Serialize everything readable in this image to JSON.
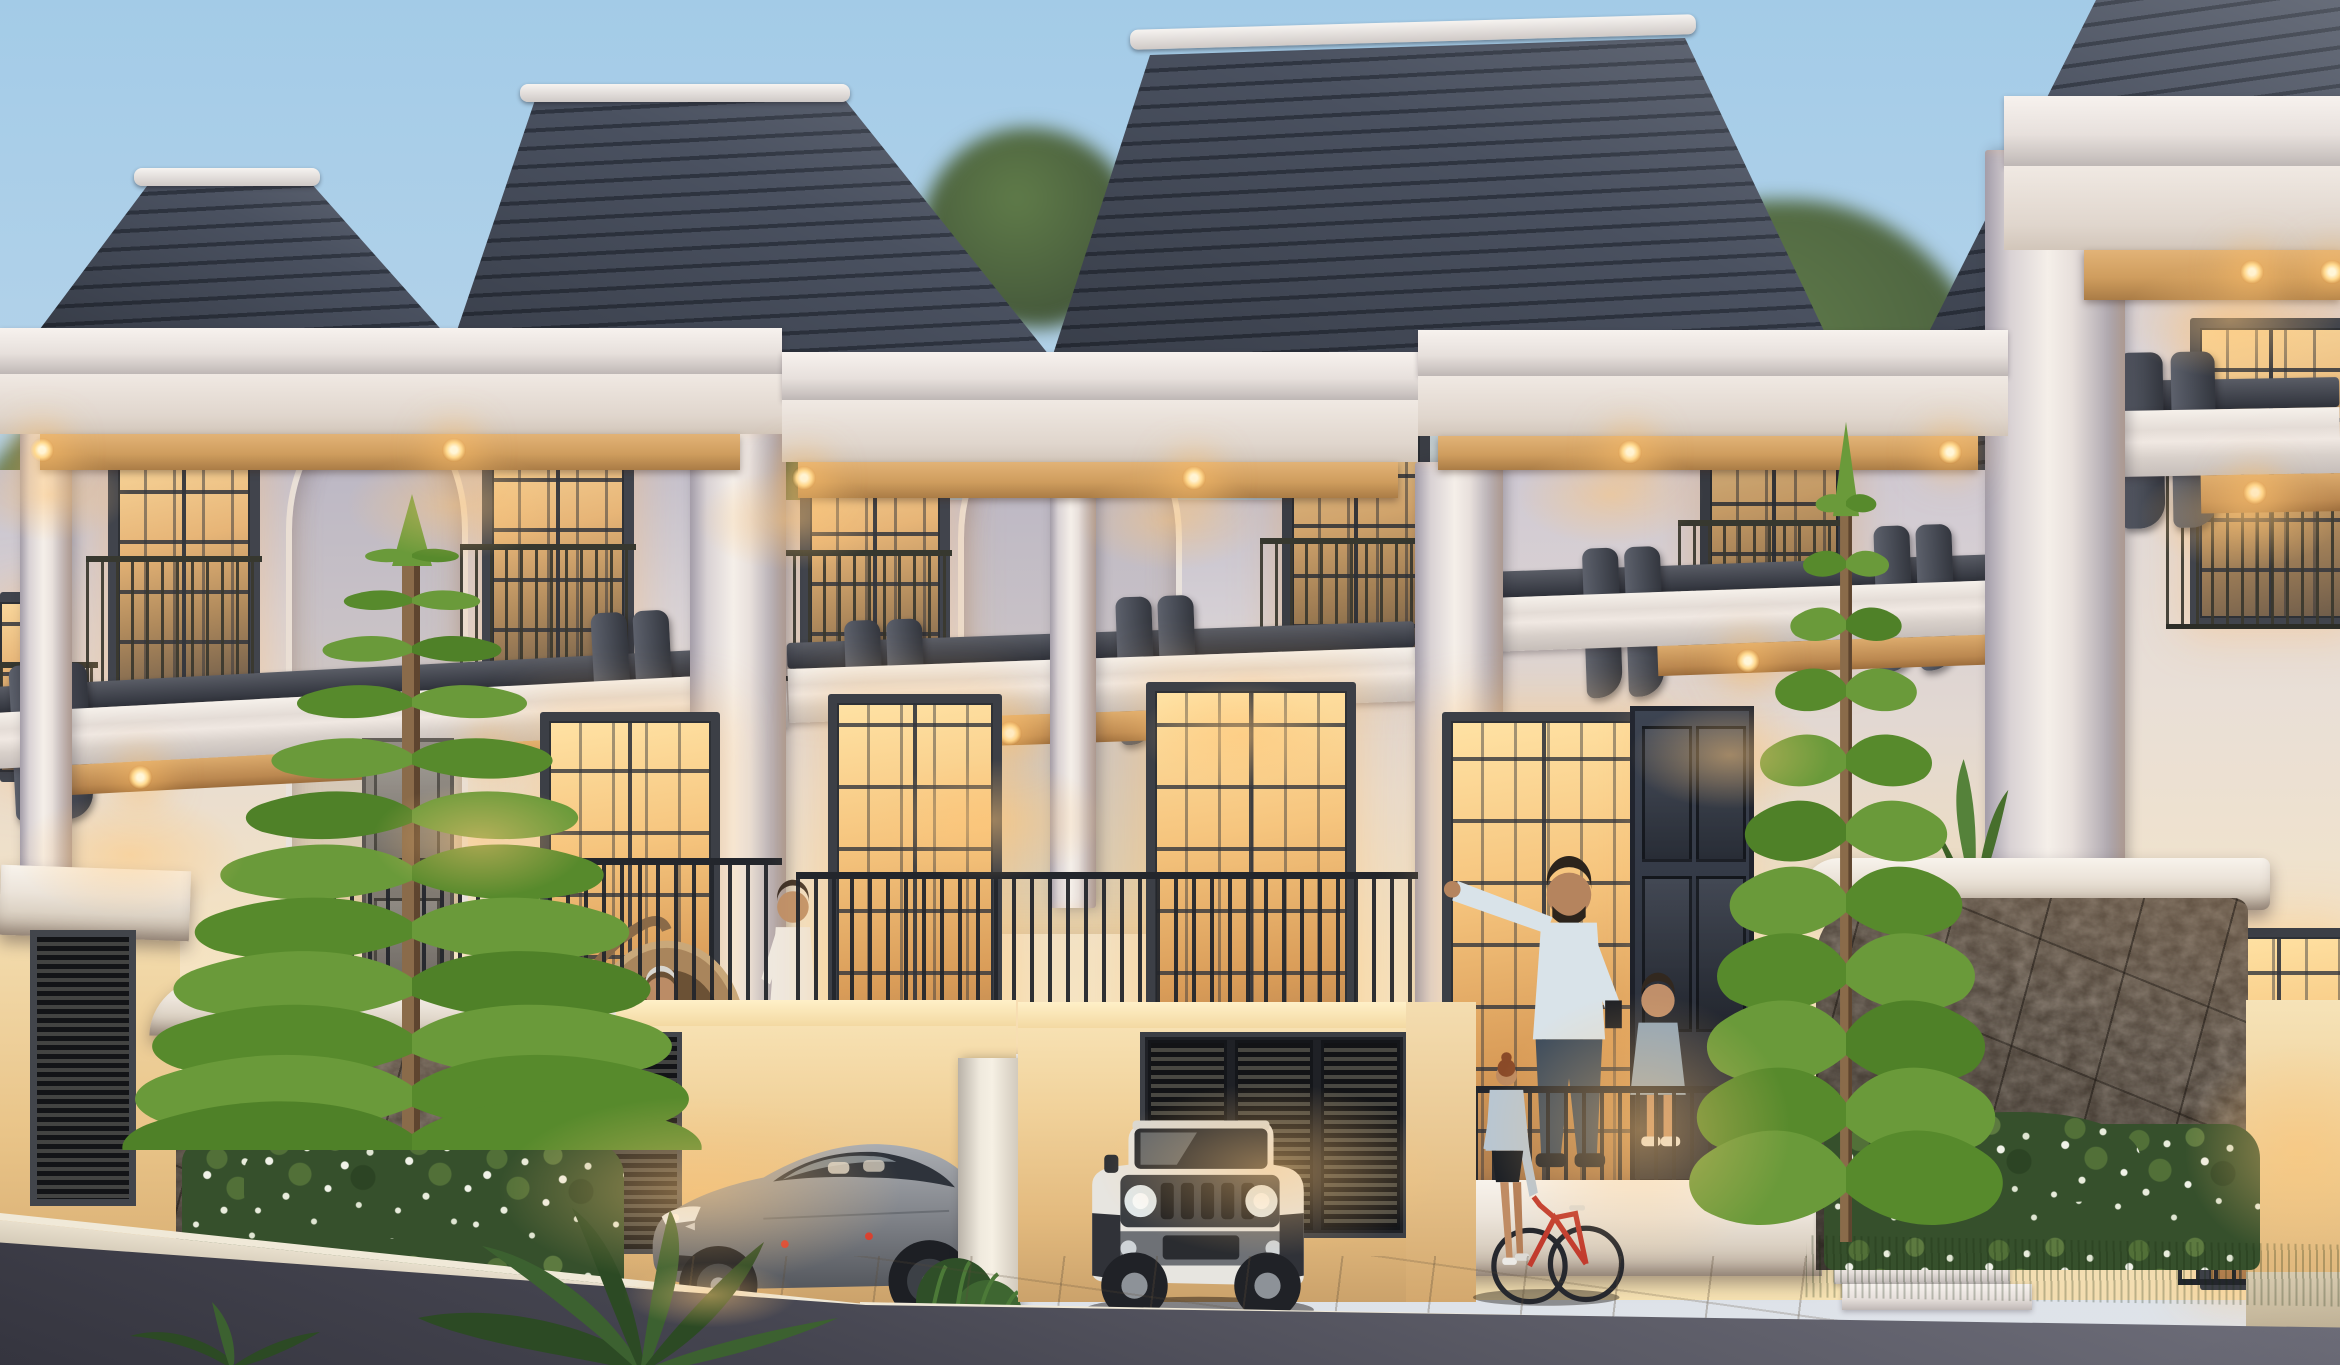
{
  "scene": {
    "description": "Dusk architectural rendering of a row of three-storey classical townhouses with warm interior lighting, balconies with residents, carports with parked cars, Norfolk pine trees, flowering hedges and a street in the foreground",
    "time_of_day": "dusk",
    "style": "photorealistic 3D exterior render",
    "sky": "clear pale blue fading warm at the horizon"
  },
  "palette": {
    "sky_top": "#a3cbe7",
    "sky_horizon": "#e0e3e9",
    "foliage_backdrop": "#526842",
    "roof_slate": "#39404c",
    "roof_ridge_white": "#f2efec",
    "facade_cool": "#cfc9d2",
    "facade_warm": "#f7e3bd",
    "trim_white": "#f6f1ec",
    "wood_soffit": "#cf9d5e",
    "downlight_glow": "#ffd98e",
    "corbel_charcoal": "#41454f",
    "window_frame": "#41444c",
    "glass_warm": "#e2af6e",
    "railing_iron": "#2b2e34",
    "stone_cladding": "#51463c",
    "hedge_green": "#3c5430",
    "hedge_flowers": "#eef0e8",
    "grass": "#577436",
    "pavement": "#cfc6b8",
    "asphalt": "#4a4a55",
    "pine_green": "#5f8f33",
    "bike_red": "#c23b2e",
    "sedan_grey": "#8d9096",
    "suv_white": "#e4e2dd"
  },
  "objects": {
    "houses": {
      "count_visible": 4,
      "storeys": 3,
      "features": [
        "hip slate roofs with white ridge caps",
        "white classical entablatures with recessed warm downlights",
        "timber soffits",
        "juliet balconies with iron railings",
        "charcoal scroll corbels",
        "arched wall recesses",
        "stone-clad ground floor",
        "carports"
      ]
    },
    "vehicles": [
      {
        "name": "grey electric sedan",
        "location": "left carport"
      },
      {
        "name": "white compact 4x4",
        "location": "middle carport"
      }
    ],
    "people": [
      {
        "name": "seated elderly man in hanging rattan egg chair",
        "location": "left balcony"
      },
      {
        "name": "standing woman in white blouse",
        "location": "left balcony"
      },
      {
        "name": "bearded man in light shirt pointing",
        "location": "middle porch balcony"
      },
      {
        "name": "young girl in denim dress",
        "location": "middle porch balcony"
      },
      {
        "name": "woman walking a red bicycle",
        "location": "driveway"
      }
    ],
    "vegetation": [
      {
        "name": "norfolk pine",
        "count": 2
      },
      {
        "name": "flowering hedge",
        "count": 2
      },
      {
        "name": "background tree canopy",
        "count": 1
      },
      {
        "name": "fan palm fronds",
        "location": "bottom left"
      },
      {
        "name": "banana leaf plant",
        "location": "porch"
      }
    ],
    "street": {
      "elements": [
        "paved driveway",
        "light concrete sidewalk with curb",
        "asphalt road"
      ]
    }
  }
}
